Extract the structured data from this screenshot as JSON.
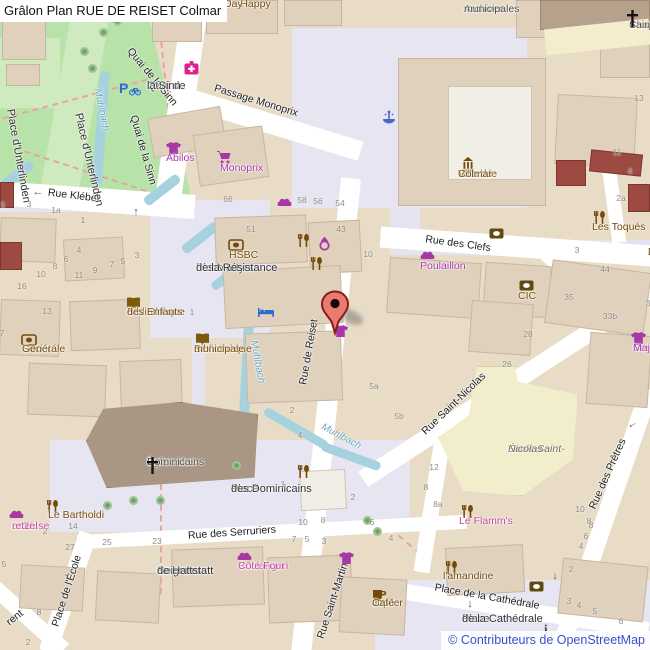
{
  "title": "Grâlon Plan RUE DE REISET Colmar",
  "attribution": "© Contributeurs de OpenStreetMap",
  "colors": {
    "park": "#b7e3a9",
    "water": "#a6d2de",
    "block": "#e9dcc7",
    "pedestrian": "#e6e5f1",
    "road": "#ffffff",
    "building": "#e0d1bd",
    "church_building": "#a99685",
    "school_building": "#f2eecb",
    "red_building": "#9c4a42",
    "marker_red": "#e97b70",
    "marker_border": "#8a1c15",
    "amenity_brown": "#734a08",
    "shop_magenta": "#a838a8",
    "shop_pink": "#bf4a96",
    "attribution_blue": "#3c50c8"
  },
  "marker": {
    "name": "rue-de-reiset-marker",
    "x": 335,
    "y": 334
  },
  "street_labels": [
    {
      "name": "street-quai-de-la-sinn-upper",
      "text": "Quai de la Sinn",
      "x": 152,
      "y": 77,
      "rot": 50
    },
    {
      "name": "street-quai-de-la-sinn-lower",
      "text": "Quai de la Sinn",
      "x": 143,
      "y": 150,
      "rot": 74
    },
    {
      "name": "street-passage-monoprix",
      "text": "Passage Monoprix",
      "x": 256,
      "y": 101,
      "rot": 17
    },
    {
      "name": "street-rue-kleber",
      "text": "Rue Kléber",
      "x": 74,
      "y": 196,
      "rot": 7
    },
    {
      "name": "street-rue-des-clefs",
      "text": "Rue des Clefs",
      "x": 458,
      "y": 244,
      "rot": 8
    },
    {
      "name": "street-rue-de-reiset",
      "text": "Rue de Reiset",
      "x": 309,
      "y": 352,
      "rot": -80
    },
    {
      "name": "street-rue-saint-martin",
      "text": "Rue Saint-Martin",
      "x": 333,
      "y": 601,
      "rot": -72
    },
    {
      "name": "street-rue-saint-nicolas",
      "text": "Rue Saint-Nicolas",
      "x": 454,
      "y": 404,
      "rot": -44
    },
    {
      "name": "street-rue-des-pretres",
      "text": "Rue des Prêtres",
      "x": 608,
      "y": 474,
      "rot": -66
    },
    {
      "name": "street-rue-des-serruriers",
      "text": "Rue des Serruriers",
      "x": 232,
      "y": 533,
      "rot": -4
    },
    {
      "name": "street-place-de-l-ecole",
      "text": "Place de l'École",
      "x": 67,
      "y": 591,
      "rot": -72
    },
    {
      "name": "street-rent-partial",
      "text": "rent",
      "x": 15,
      "y": 618,
      "rot": -38
    },
    {
      "name": "street-place-de-la-cathedrale",
      "text": "Place de la Cathédrale",
      "x": 487,
      "y": 597,
      "rot": 10
    }
  ],
  "place_labels": [
    {
      "name": "place-d-unterlinden-1",
      "lines": [
        "Place d'Unterlinden"
      ],
      "x": 16,
      "y": 108,
      "rot": 80,
      "cls": "place"
    },
    {
      "name": "place-d-unterlinden-2",
      "lines": [
        "Place d'Unterlinden"
      ],
      "x": 84,
      "y": 112,
      "rot": 77,
      "cls": "place"
    },
    {
      "name": "quai-de-la-sinn-two-line",
      "lines": [
        "Quai de",
        "la Sinn"
      ],
      "x": 147,
      "y": 80,
      "rot": 0,
      "cls": "place"
    },
    {
      "name": "place-des-martyrs",
      "lines": [
        "Place",
        "des Martyrs",
        "de la Résistance"
      ],
      "x": 196,
      "y": 262,
      "rot": 0,
      "cls": "place"
    },
    {
      "name": "archives-municipales",
      "lines": [
        "Archives",
        "municipales"
      ],
      "x": 464,
      "y": 3,
      "rot": 0,
      "cls": "civic"
    },
    {
      "name": "chapelle-saint-andre",
      "lines": [
        "Chapelle",
        "Saint-André"
      ],
      "x": 629,
      "y": 19,
      "rot": 0,
      "cls": "church"
    },
    {
      "name": "place-des-dominicains",
      "lines": [
        "Place",
        "des Dominicains"
      ],
      "x": 231,
      "y": 483,
      "rot": 0,
      "cls": "place"
    },
    {
      "name": "eglise-des-dominicains",
      "lines": [
        "Église des",
        "Dominicains"
      ],
      "x": 147,
      "y": 456,
      "rot": 0,
      "cls": "church"
    },
    {
      "name": "cour-des-seigneurs-de-hattstatt",
      "lines": [
        "Cour des",
        "Seigneurs",
        "de Hattstatt"
      ],
      "x": 157,
      "y": 565,
      "rot": 0,
      "cls": "place"
    },
    {
      "name": "place-de-la-cathedrale",
      "lines": [
        "Place",
        "de la Cathédrale"
      ],
      "x": 462,
      "y": 613,
      "rot": 0,
      "cls": "place"
    },
    {
      "name": "ecole-saint-nicolas",
      "lines": [
        "École Saint-",
        "Nicolas"
      ],
      "x": 508,
      "y": 443,
      "rot": 0,
      "cls": "school"
    },
    {
      "name": "ecole-d-art-partial",
      "lines": [
        "E",
        "d'Art Co",
        "A",
        "M"
      ],
      "x": 648,
      "y": 246,
      "rot": 0,
      "cls": "brown"
    }
  ],
  "poi_labels": [
    {
      "name": "poi-un-happy-day",
      "icon": null,
      "ix": 0,
      "iy": 0,
      "lines": [
        "Un Happy",
        "Day"
      ],
      "x": 224,
      "y": -2,
      "cls": "brown"
    },
    {
      "name": "poi-abilos",
      "icon": "tshirt",
      "ix": 166,
      "iy": 142,
      "lines": [
        "Abilos"
      ],
      "x": 166,
      "y": 152,
      "cls": "magenta"
    },
    {
      "name": "poi-monoprix",
      "icon": "cart",
      "ix": 217,
      "iy": 151,
      "lines": [
        "Monoprix"
      ],
      "x": 220,
      "y": 162,
      "cls": "magenta"
    },
    {
      "name": "poi-hsbc",
      "icon": "bank",
      "ix": 228,
      "iy": 239,
      "lines": [
        "HSBC"
      ],
      "x": 229,
      "y": 249,
      "cls": "brown"
    },
    {
      "name": "poi-hotel-de-ville",
      "icon": "townhall",
      "ix": 460,
      "iy": 157,
      "lines": [
        "Hôtel de",
        "Ville de",
        "Colmar"
      ],
      "x": 458,
      "y": 168,
      "cls": "brown"
    },
    {
      "name": "poi-les-toques",
      "icon": "restaurant",
      "ix": 593,
      "iy": 211,
      "lines": [
        "Les Toqués"
      ],
      "x": 592,
      "y": 221,
      "cls": "brown"
    },
    {
      "name": "poi-poulaillon",
      "icon": "bread",
      "ix": 420,
      "iy": 250,
      "lines": [
        "Poulaillon"
      ],
      "x": 420,
      "y": 260,
      "cls": "magenta"
    },
    {
      "name": "poi-cic",
      "icon": "atm",
      "ix": 519,
      "iy": 280,
      "lines": [
        "CIC"
      ],
      "x": 518,
      "y": 290,
      "cls": "brown"
    },
    {
      "name": "poi-sergent-major",
      "icon": "tshirt",
      "ix": 631,
      "iy": 332,
      "lines": [
        "Sergent",
        "Major"
      ],
      "x": 633,
      "y": 342,
      "cls": "magenta"
    },
    {
      "name": "poi-societe-generale",
      "icon": "bank",
      "ix": 21,
      "iy": 334,
      "lines": [
        "Société",
        "Générale"
      ],
      "x": 22,
      "y": 343,
      "cls": "brown"
    },
    {
      "name": "poi-bibliotheque-des-enfants",
      "icon": "book",
      "ix": 126,
      "iy": 297,
      "lines": [
        "Bibliothèque",
        "des Enfants"
      ],
      "x": 127,
      "y": 306,
      "cls": "brown"
    },
    {
      "name": "poi-bibliotheque-municipale",
      "icon": "book",
      "ix": 195,
      "iy": 333,
      "lines": [
        "Bibliothèque",
        "municipale"
      ],
      "x": 194,
      "y": 343,
      "cls": "brown"
    },
    {
      "name": "poi-le-bartholdi",
      "icon": "restaurant",
      "ix": 46,
      "iy": 500,
      "lines": [
        "Le Bartholdi"
      ],
      "x": 48,
      "y": 509,
      "cls": "brown"
    },
    {
      "name": "poi-boulangerie-cote-four",
      "icon": "bread",
      "ix": 237,
      "iy": 551,
      "lines": [
        "Boulangeri",
        "Côte Four"
      ],
      "x": 238,
      "y": 560,
      "cls": "pink"
    },
    {
      "name": "poi-le-flamms",
      "icon": "restaurant",
      "ix": 461,
      "iy": 505,
      "lines": [
        "Le Flamm's"
      ],
      "x": 459,
      "y": 515,
      "cls": "pink"
    },
    {
      "name": "poi-l-amandine",
      "icon": "restaurant",
      "ix": 445,
      "iy": 561,
      "lines": [
        "l'amandine"
      ],
      "x": 443,
      "y": 570,
      "cls": "brown"
    },
    {
      "name": "poi-jupiler-cafe",
      "icon": "cafe",
      "ix": 372,
      "iy": 588,
      "lines": [
        "Jupiler",
        "Café"
      ],
      "x": 372,
      "y": 597,
      "cls": "brown"
    },
    {
      "name": "poi-shop-partial-left",
      "icon": null,
      "ix": 0,
      "iy": 0,
      "lines": [
        "oullé-",
        "ameuse",
        "retzel"
      ],
      "x": 12,
      "y": 520,
      "cls": "pink"
    }
  ],
  "standalone_icons": [
    {
      "name": "pharmacy-icon",
      "icon": "pharmacy",
      "x": 184,
      "y": 61
    },
    {
      "name": "parking-icon",
      "icon": "parking",
      "x": 119,
      "y": 80
    },
    {
      "name": "fountain-icon",
      "icon": "fountain",
      "x": 382,
      "y": 110
    },
    {
      "name": "bakery-icon-top",
      "icon": "bread",
      "x": 277,
      "y": 197
    },
    {
      "name": "restaurant-icon-1",
      "icon": "restaurant",
      "x": 297,
      "y": 234
    },
    {
      "name": "jewelry-icon",
      "icon": "ring",
      "x": 318,
      "y": 237
    },
    {
      "name": "restaurant-icon-2",
      "icon": "restaurant",
      "x": 310,
      "y": 257
    },
    {
      "name": "hotel-bed-icon",
      "icon": "bed",
      "x": 258,
      "y": 307
    },
    {
      "name": "atm-icon-clefs",
      "icon": "atm",
      "x": 489,
      "y": 228
    },
    {
      "name": "restaurant-icon-3",
      "icon": "restaurant",
      "x": 297,
      "y": 465
    },
    {
      "name": "clothes-icon-martin",
      "icon": "tshirt",
      "x": 339,
      "y": 552
    },
    {
      "name": "clothes-icon-marker",
      "icon": "tshirt",
      "x": 333,
      "y": 325
    },
    {
      "name": "bakery-icon-left",
      "icon": "bread",
      "x": 9,
      "y": 509
    },
    {
      "name": "atm-icon-cathedrale",
      "icon": "atm",
      "x": 529,
      "y": 581
    },
    {
      "name": "info-icon",
      "icon": "info",
      "x": 543,
      "y": 622
    },
    {
      "name": "church-cross-dominicains-icon",
      "icon": "cross",
      "x": 146,
      "y": 457
    },
    {
      "name": "church-cross-chapelle-icon",
      "icon": "cross",
      "x": 626,
      "y": 10
    }
  ],
  "arrows": [
    {
      "name": "oneway-arrow-kleber",
      "glyph": "←",
      "x": 38,
      "y": 192,
      "rot": 0
    },
    {
      "name": "oneway-arrow-sinn",
      "glyph": "↑",
      "x": 136,
      "y": 212,
      "rot": 0
    },
    {
      "name": "oneway-arrow-cathedrale",
      "glyph": "↓",
      "x": 555,
      "y": 576,
      "rot": 0
    },
    {
      "name": "oneway-arrow-pretres",
      "glyph": "←",
      "x": 632,
      "y": 424,
      "rot": -30
    },
    {
      "name": "place-cathedrale-pointer-arrow",
      "glyph": "↓",
      "x": 470,
      "y": 604,
      "rot": 0
    }
  ],
  "water_labels": [
    {
      "name": "water-muhlbach-1",
      "text": "Muhlbach",
      "x": 101,
      "y": 110,
      "rot": 78
    },
    {
      "name": "water-muhlbach-2",
      "text": "Muhlbach",
      "x": 257,
      "y": 362,
      "rot": 80
    },
    {
      "name": "water-muhlbach-3",
      "text": "Muhlbach",
      "x": 341,
      "y": 437,
      "rot": 28
    }
  ],
  "house_numbers": [
    {
      "t": "5",
      "x": 3,
      "y": 205
    },
    {
      "t": "3",
      "x": 29,
      "y": 204
    },
    {
      "t": "1a",
      "x": 56,
      "y": 210
    },
    {
      "t": "1",
      "x": 83,
      "y": 220
    },
    {
      "t": "4",
      "x": 79,
      "y": 250
    },
    {
      "t": "6",
      "x": 66,
      "y": 259
    },
    {
      "t": "8",
      "x": 55,
      "y": 266
    },
    {
      "t": "10",
      "x": 41,
      "y": 274
    },
    {
      "t": "16",
      "x": 22,
      "y": 286
    },
    {
      "t": "11",
      "x": 79,
      "y": 275
    },
    {
      "t": "9",
      "x": 95,
      "y": 270
    },
    {
      "t": "7",
      "x": 112,
      "y": 264
    },
    {
      "t": "5",
      "x": 123,
      "y": 261
    },
    {
      "t": "3",
      "x": 137,
      "y": 255
    },
    {
      "t": "66",
      "x": 228,
      "y": 199
    },
    {
      "t": "58",
      "x": 302,
      "y": 200
    },
    {
      "t": "56",
      "x": 318,
      "y": 201
    },
    {
      "t": "54",
      "x": 340,
      "y": 203
    },
    {
      "t": "51",
      "x": 251,
      "y": 229
    },
    {
      "t": "43",
      "x": 341,
      "y": 229
    },
    {
      "t": "10",
      "x": 368,
      "y": 254
    },
    {
      "t": "13",
      "x": 639,
      "y": 98
    },
    {
      "t": "11",
      "x": 617,
      "y": 152
    },
    {
      "t": "4",
      "x": 630,
      "y": 171
    },
    {
      "t": "2a",
      "x": 621,
      "y": 198
    },
    {
      "t": "3",
      "x": 577,
      "y": 250
    },
    {
      "t": "44",
      "x": 605,
      "y": 269
    },
    {
      "t": "35",
      "x": 569,
      "y": 297
    },
    {
      "t": "33b",
      "x": 610,
      "y": 316
    },
    {
      "t": "3",
      "x": 648,
      "y": 303
    },
    {
      "t": "28",
      "x": 528,
      "y": 334
    },
    {
      "t": "5a",
      "x": 374,
      "y": 386
    },
    {
      "t": "5b",
      "x": 399,
      "y": 416
    },
    {
      "t": "2",
      "x": 292,
      "y": 410
    },
    {
      "t": "4",
      "x": 300,
      "y": 435
    },
    {
      "t": "26",
      "x": 507,
      "y": 364
    },
    {
      "t": "12",
      "x": 434,
      "y": 467
    },
    {
      "t": "8",
      "x": 426,
      "y": 487
    },
    {
      "t": "8a",
      "x": 438,
      "y": 504
    },
    {
      "t": "1",
      "x": 283,
      "y": 484
    },
    {
      "t": "2",
      "x": 353,
      "y": 497
    },
    {
      "t": "1",
      "x": 192,
      "y": 312
    },
    {
      "t": "13",
      "x": 47,
      "y": 311
    },
    {
      "t": "7",
      "x": 2,
      "y": 333
    },
    {
      "t": "10",
      "x": 303,
      "y": 522
    },
    {
      "t": "8",
      "x": 323,
      "y": 520
    },
    {
      "t": "6",
      "x": 372,
      "y": 522
    },
    {
      "t": "4",
      "x": 391,
      "y": 538
    },
    {
      "t": "7",
      "x": 294,
      "y": 539
    },
    {
      "t": "5",
      "x": 307,
      "y": 539
    },
    {
      "t": "3",
      "x": 324,
      "y": 541
    },
    {
      "t": "2",
      "x": 45,
      "y": 531
    },
    {
      "t": "14",
      "x": 73,
      "y": 526
    },
    {
      "t": "27",
      "x": 70,
      "y": 547
    },
    {
      "t": "25",
      "x": 107,
      "y": 542
    },
    {
      "t": "23",
      "x": 157,
      "y": 541
    },
    {
      "t": "5",
      "x": 4,
      "y": 564
    },
    {
      "t": "8",
      "x": 39,
      "y": 612
    },
    {
      "t": "2",
      "x": 28,
      "y": 642
    },
    {
      "t": "8",
      "x": 591,
      "y": 525
    },
    {
      "t": "6",
      "x": 586,
      "y": 536
    },
    {
      "t": "4",
      "x": 581,
      "y": 546
    },
    {
      "t": "2",
      "x": 571,
      "y": 569
    },
    {
      "t": "3",
      "x": 569,
      "y": 601
    },
    {
      "t": "4",
      "x": 579,
      "y": 605
    },
    {
      "t": "5",
      "x": 595,
      "y": 611
    },
    {
      "t": "6",
      "x": 621,
      "y": 621
    },
    {
      "t": "10",
      "x": 580,
      "y": 509
    },
    {
      "t": "8",
      "x": 589,
      "y": 521
    }
  ]
}
